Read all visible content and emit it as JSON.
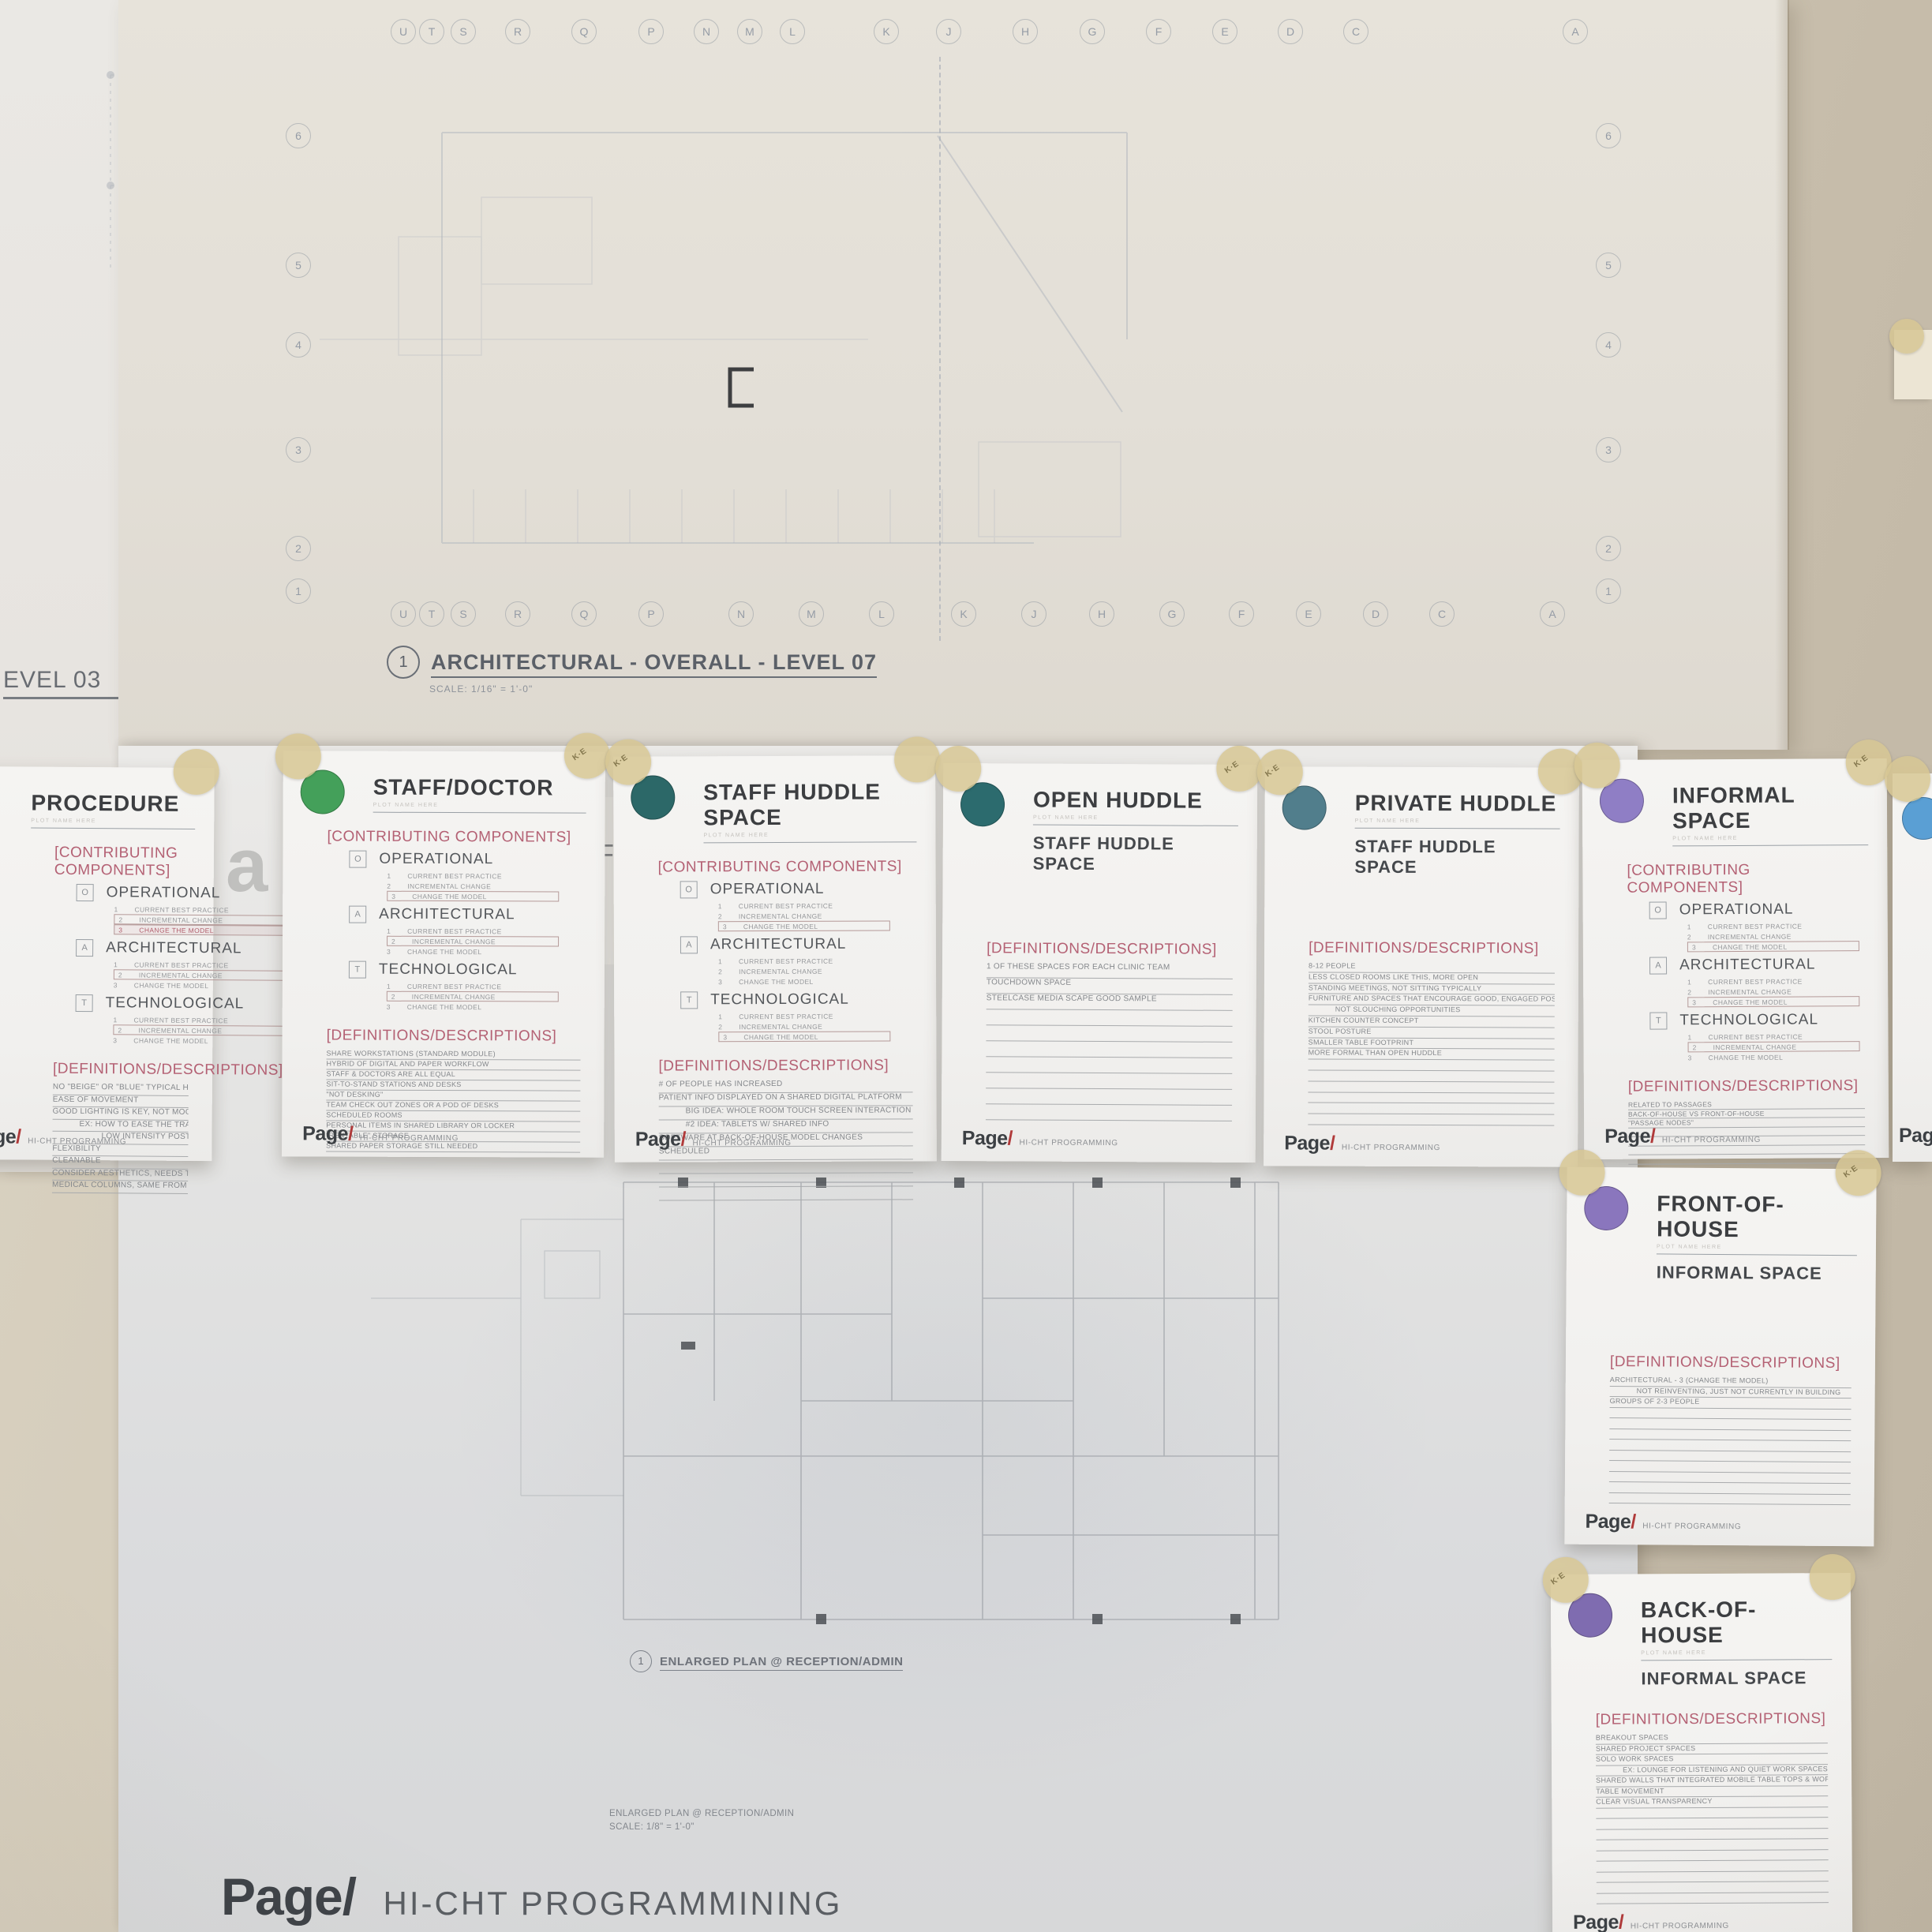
{
  "left_sheet": {
    "label": "EVEL 03"
  },
  "top_sheet": {
    "grid_letters_top": [
      "U",
      "T",
      "S",
      "R",
      "Q",
      "P",
      "N",
      "M",
      "L",
      "K",
      "J",
      "H",
      "G",
      "F",
      "E",
      "D",
      "C",
      "A"
    ],
    "grid_letters_bottom": [
      "U",
      "T",
      "S",
      "R",
      "Q",
      "P",
      "N",
      "M",
      "L",
      "K",
      "J",
      "H",
      "G",
      "F",
      "E",
      "D",
      "C",
      "A"
    ],
    "row_numbers": [
      "6",
      "5",
      "4",
      "3",
      "2",
      "1"
    ],
    "title": {
      "number": "1",
      "label": "ARCHITECTURAL - OVERALL - LEVEL 07",
      "scale": "SCALE:  1/16\" = 1'-0\""
    }
  },
  "bottom_sheet": {
    "plan_label": {
      "number": "1",
      "label": "ENLARGED PLAN @ RECEPTION/ADMIN"
    },
    "plan_sub_line1": "ENLARGED PLAN @ RECEPTION/ADMIN",
    "plan_sub_line2": "SCALE:  1/8\" = 1'-0\"",
    "brand": "Page/",
    "tagline": "HI-CHT PROGRAMMINING"
  },
  "fragments": {
    "letter_f": "F",
    "letter_a": "a"
  },
  "card_defaults": {
    "components_heading": "[CONTRIBUTING COMPONENTS]",
    "definitions_heading": "[DEFINITIONS/DESCRIPTIONS]",
    "component_items": [
      "CURRENT BEST PRACTICE",
      "INCREMENTAL CHANGE",
      "CHANGE THE MODEL"
    ],
    "item_numbers": [
      "1",
      "2",
      "3"
    ],
    "title_note": "PLOT NAME HERE",
    "footer_brand_name": "Page",
    "footer_brand_slash": "/",
    "footer_tagline": "HI-CHT PROGRAMMING",
    "tape_label": "K∙E"
  },
  "cards": [
    {
      "id": "procedure",
      "title": "PROCEDURE",
      "subtitle": null,
      "circle_color": null,
      "components": [
        {
          "letter": "O",
          "name": "OPERATIONAL",
          "boxed": [
            2,
            3
          ],
          "accent": [
            3
          ]
        },
        {
          "letter": "A",
          "name": "ARCHITECTURAL",
          "boxed": [
            2
          ],
          "accent": []
        },
        {
          "letter": "T",
          "name": "TECHNOLOGICAL",
          "boxed": [
            2
          ],
          "accent": []
        }
      ],
      "definitions": [
        {
          "text": "NO \"BEIGE\" OR \"BLUE\" TYPICAL HEALTHCARE COLORS"
        },
        {
          "text": "EASE OF MOVEMENT"
        },
        {
          "text": "GOOD LIGHTING IS KEY, NOT MOOD LIGHTING"
        },
        {
          "text": "EX: HOW TO EASE THE TRANSITION FROM HIGH INTENSITY SURGERY TO",
          "indent": 1
        },
        {
          "text": "LOW INTENSITY POST SURGERY",
          "indent": 2
        },
        {
          "text": "FLEXIBILITY"
        },
        {
          "text": "CLEANABLE"
        },
        {
          "text": "CONSIDER AESTHETICS, NEEDS TO LOOK \"GREAT\" EX: SPA"
        },
        {
          "text": "MEDICAL COLUMNS, SAME FROM ASC"
        }
      ],
      "blank_lines": 0
    },
    {
      "id": "staff-doctor",
      "title": "STAFF/DOCTOR",
      "subtitle": null,
      "circle_color": "#44a05a",
      "components": [
        {
          "letter": "O",
          "name": "OPERATIONAL",
          "boxed": [
            3
          ],
          "accent": []
        },
        {
          "letter": "A",
          "name": "ARCHITECTURAL",
          "boxed": [
            2
          ],
          "accent": []
        },
        {
          "letter": "T",
          "name": "TECHNOLOGICAL",
          "boxed": [
            2
          ],
          "accent": []
        }
      ],
      "definitions": [
        {
          "text": "SHARE WORKSTATIONS (STANDARD MODULE)"
        },
        {
          "text": "HYBRID OF DIGITAL AND PAPER WORKFLOW"
        },
        {
          "text": "STAFF & DOCTORS ARE ALL EQUAL"
        },
        {
          "text": "SIT-TO-STAND STATIONS AND DESKS"
        },
        {
          "text": "\"NOT DESKING\""
        },
        {
          "text": "TEAM CHECK OUT ZONES OR A POD OF DESKS"
        },
        {
          "text": "SCHEDULED ROOMS"
        },
        {
          "text": "PERSONAL ITEMS IN SHARED LIBRARY OR LOCKER"
        },
        {
          "text": "\"RENTABLE\" STORAGE"
        },
        {
          "text": "SHARED PAPER STORAGE STILL NEEDED"
        }
      ],
      "blank_lines": 0
    },
    {
      "id": "staff-huddle",
      "title": "STAFF HUDDLE SPACE",
      "subtitle": null,
      "circle_color": "#2c6868",
      "components": [
        {
          "letter": "O",
          "name": "OPERATIONAL",
          "boxed": [
            3
          ],
          "accent": []
        },
        {
          "letter": "A",
          "name": "ARCHITECTURAL",
          "boxed": [],
          "accent": []
        },
        {
          "letter": "T",
          "name": "TECHNOLOGICAL",
          "boxed": [
            3
          ],
          "accent": []
        }
      ],
      "definitions": [
        {
          "text": "# OF PEOPLE HAS INCREASED"
        },
        {
          "text": "PATIENT INFO DISPLAYED ON A SHARED DIGITAL PLATFORM"
        },
        {
          "text": "BIG IDEA: WHOLE ROOM TOUCH SCREEN INTERACTION",
          "indent": 1
        },
        {
          "text": "#2 IDEA: TABLETS W/ SHARED INFO",
          "indent": 1
        },
        {
          "text": "SOFTWARE AT BACK-OF-HOUSE MODEL CHANGES"
        },
        {
          "text": "SCHEDULED"
        }
      ],
      "blank_lines": 3
    },
    {
      "id": "open-huddle",
      "title": "OPEN HUDDLE",
      "subtitle": "STAFF HUDDLE SPACE",
      "circle_color": "#2c6b6e",
      "components": null,
      "definitions": [
        {
          "text": "1 OF THESE SPACES FOR EACH CLINIC TEAM"
        },
        {
          "text": "TOUCHDOWN SPACE"
        },
        {
          "text": "STEELCASE MEDIA SCAPE GOOD SAMPLE"
        }
      ],
      "blank_lines": 7
    },
    {
      "id": "private-huddle",
      "title": "PRIVATE HUDDLE",
      "subtitle": "STAFF HUDDLE SPACE",
      "circle_color": "#517e8c",
      "components": null,
      "definitions": [
        {
          "text": "8-12 PEOPLE"
        },
        {
          "text": "LESS CLOSED ROOMS LIKE THIS, MORE OPEN"
        },
        {
          "text": "STANDING MEETINGS, NOT SITTING TYPICALLY"
        },
        {
          "text": "FURNITURE AND SPACES THAT ENCOURAGE GOOD, ENGAGED POSTURE"
        },
        {
          "text": "NOT SLOUCHING OPPORTUNITIES",
          "indent": 1
        },
        {
          "text": "KITCHEN COUNTER CONCEPT"
        },
        {
          "text": "STOOL POSTURE"
        },
        {
          "text": "SMALLER TABLE FOOTPRINT"
        },
        {
          "text": "MORE FORMAL THAN OPEN HUDDLE"
        }
      ],
      "blank_lines": 6
    },
    {
      "id": "informal",
      "title": "INFORMAL SPACE",
      "subtitle": null,
      "circle_color": "#8f7ec5",
      "components": [
        {
          "letter": "O",
          "name": "OPERATIONAL",
          "boxed": [
            3
          ],
          "accent": []
        },
        {
          "letter": "A",
          "name": "ARCHITECTURAL",
          "boxed": [
            3
          ],
          "accent": []
        },
        {
          "letter": "T",
          "name": "TECHNOLOGICAL",
          "boxed": [
            2
          ],
          "accent": []
        }
      ],
      "definitions": [
        {
          "text": "RELATED TO PASSAGES"
        },
        {
          "text": "BACK-OF-HOUSE VS FRONT-OF-HOUSE"
        },
        {
          "text": "\"PASSAGE NODES\""
        }
      ],
      "blank_lines": 8
    },
    {
      "id": "partial-blue",
      "title": "",
      "subtitle": null,
      "circle_color": "#5a9fd4",
      "partial": true,
      "footer_partial": "Pag",
      "components": null,
      "definitions": [],
      "blank_lines": 0
    },
    {
      "id": "front",
      "title": "FRONT-OF-HOUSE",
      "subtitle": "INFORMAL SPACE",
      "circle_color": "#8a76bd",
      "components": null,
      "definitions": [
        {
          "text": "ARCHITECTURAL - 3 (CHANGE THE MODEL)"
        },
        {
          "text": "NOT REINVENTING, JUST NOT CURRENTLY IN BUILDING",
          "indent": 1
        },
        {
          "text": "GROUPS OF 2-3 PEOPLE"
        }
      ],
      "blank_lines": 9
    },
    {
      "id": "back",
      "title": "BACK-OF-HOUSE",
      "subtitle": "INFORMAL SPACE",
      "circle_color": "#7f6cb0",
      "components": null,
      "definitions": [
        {
          "text": "BREAKOUT SPACES"
        },
        {
          "text": "SHARED PROJECT SPACES"
        },
        {
          "text": "SOLO WORK SPACES"
        },
        {
          "text": "EX: LOUNGE FOR LISTENING AND QUIET WORK SPACES",
          "indent": 1
        },
        {
          "text": "SHARED WALLS THAT INTEGRATED MOBILE TABLE TOPS & WORK WALLS"
        },
        {
          "text": "TABLE MOVEMENT"
        },
        {
          "text": "CLEAR VISUAL TRANSPARENCY"
        }
      ],
      "blank_lines": 9
    }
  ]
}
